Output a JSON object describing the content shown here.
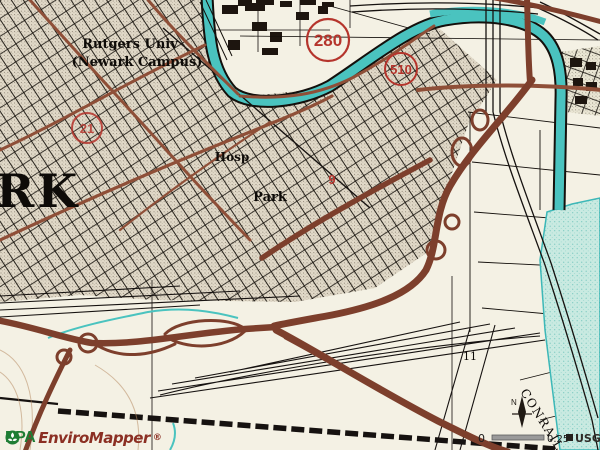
{
  "map": {
    "region_label": "RK",
    "labels": {
      "university_line1": "Rutgers Univ",
      "university_line2": "(Newark Campus)",
      "hospital": "Hosp",
      "park": "Park",
      "block_number": "11",
      "railroad": "CONRAIL",
      "point_marker": "9"
    },
    "route_shields": [
      {
        "number": "280"
      },
      {
        "number": "510"
      },
      {
        "number": "21"
      }
    ]
  },
  "scale_bar": {
    "start": "0",
    "end": "0.25",
    "attribution": "USGS",
    "north_label": "N"
  },
  "branding": {
    "agency": "EPA",
    "product": "EnviroMapper",
    "registered": "®"
  },
  "colors": {
    "paper": "#f4f1e4",
    "ink": "#14100c",
    "road_major": "#7d3f2c",
    "road_minor": "#8f4f38",
    "water": "#4ac3bf",
    "wetland": "#c9eae1",
    "shield_red": "#b5342c",
    "epa_green": "#1e7d34",
    "product_maroon": "#8b2f23"
  }
}
